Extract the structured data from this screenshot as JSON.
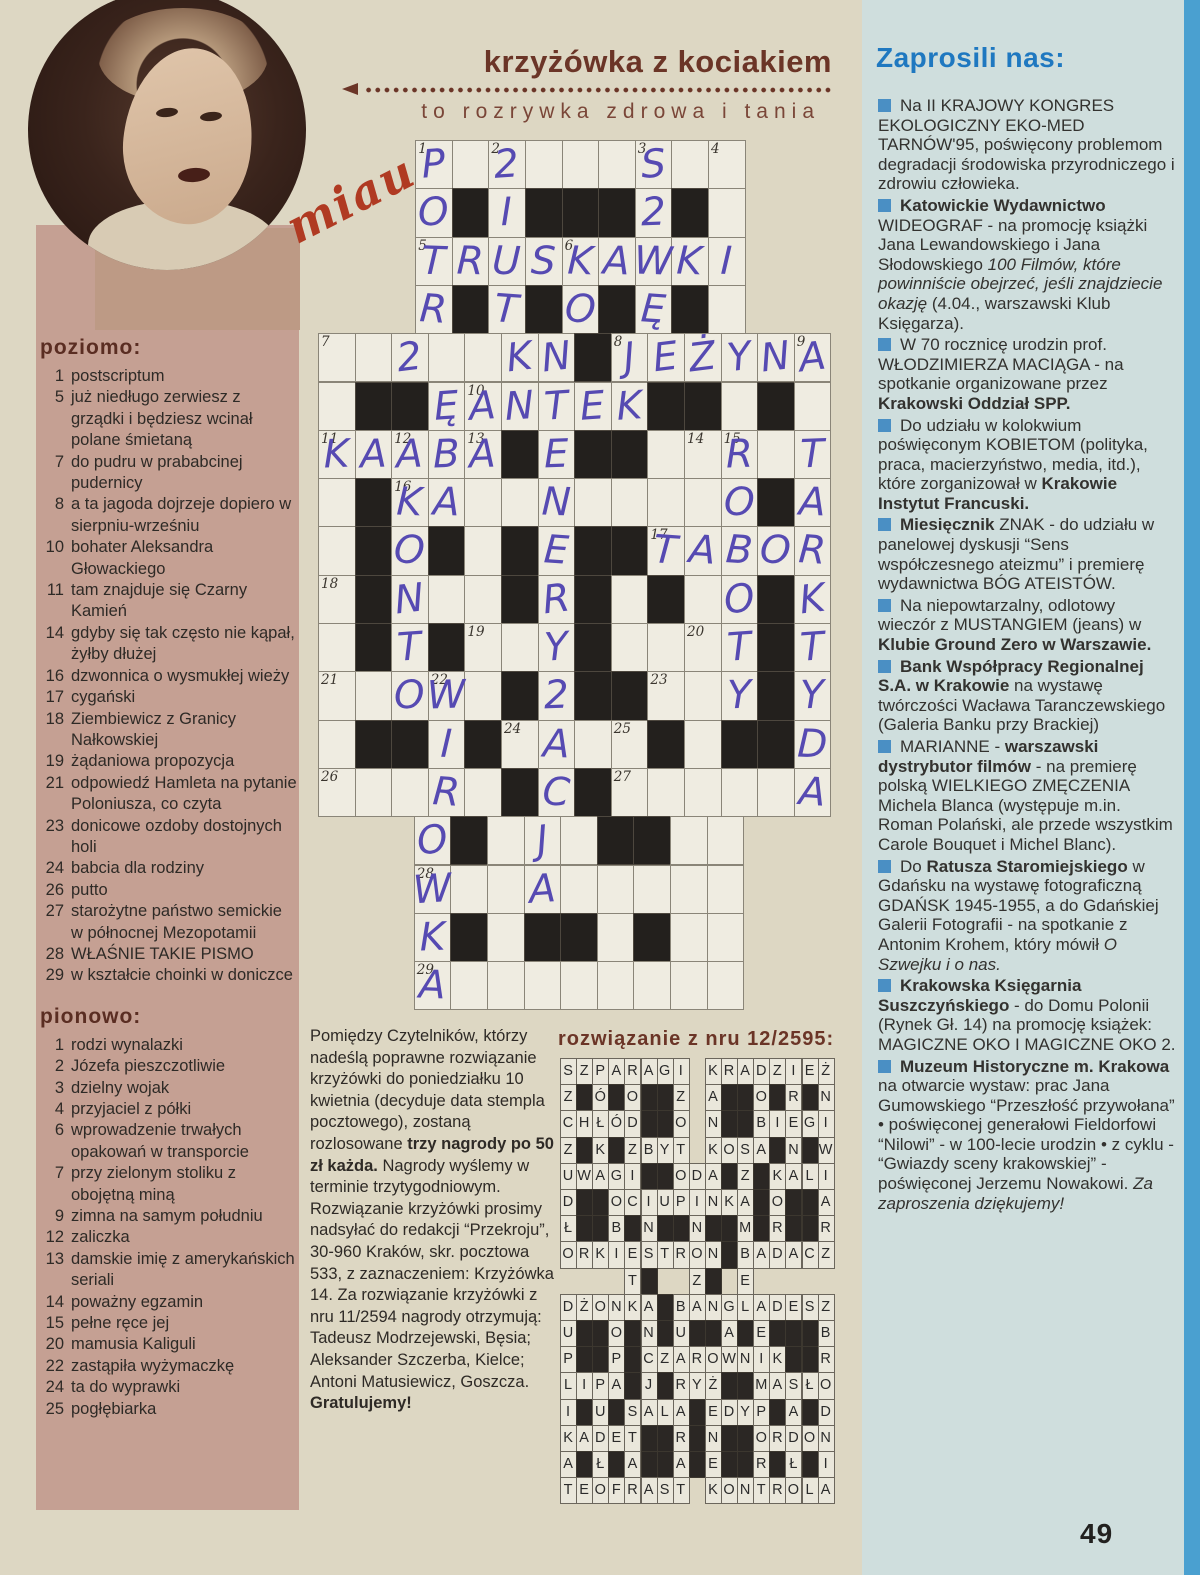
{
  "page": {
    "number": "49"
  },
  "colors": {
    "title_brown": "#6b3527",
    "heading_blue": "#1f78c0",
    "bullet_blue": "#4a8fc4",
    "handwriting_ink": "#564ab2",
    "pink_panel": "#c5a093",
    "right_panel": "#cfdedd",
    "edge_strip": "#4aa0d0"
  },
  "icons": {
    "arrow": "left-arrow-dotted-line",
    "bullet": "blue-square"
  },
  "masthead": {
    "title": "krzyżówka z kociakiem",
    "subtitle": "to rozrywka zdrowa i tania",
    "miau": "miau"
  },
  "clues": {
    "across_label": "poziomo:",
    "across": [
      {
        "num": "1",
        "text": "postscriptum"
      },
      {
        "num": "5",
        "text": "już niedługo zerwiesz z grządki i będziesz wcinał polane śmietaną"
      },
      {
        "num": "7",
        "text": "do pudru w prababcinej pudernicy"
      },
      {
        "num": "8",
        "text": "a ta jagoda dojrzeje dopiero w sierpniu-wrześniu"
      },
      {
        "num": "10",
        "text": "bohater Aleksandra Głowackiego"
      },
      {
        "num": "11",
        "text": "tam znajduje się Czarny Kamień"
      },
      {
        "num": "14",
        "text": "gdyby się tak często nie kąpał, żyłby dłużej"
      },
      {
        "num": "16",
        "text": "dzwonnica o wysmukłej wieży"
      },
      {
        "num": "17",
        "text": "cygański"
      },
      {
        "num": "18",
        "text": "Ziembiewicz z Granicy Nałkowskiej"
      },
      {
        "num": "19",
        "text": "żądaniowa propozycja"
      },
      {
        "num": "21",
        "text": "odpowiedź Hamleta na pytanie Poloniusza, co czyta"
      },
      {
        "num": "23",
        "text": "donicowe ozdoby dostojnych holi"
      },
      {
        "num": "24",
        "text": "babcia dla rodziny"
      },
      {
        "num": "26",
        "text": "putto"
      },
      {
        "num": "27",
        "text": "starożytne państwo semickie w północnej Mezopotamii"
      },
      {
        "num": "28",
        "text": "WŁAŚNIE TAKIE PISMO"
      },
      {
        "num": "29",
        "text": "w kształcie choinki w doniczce"
      }
    ],
    "down_label": "pionowo:",
    "down": [
      {
        "num": "1",
        "text": "rodzi wynalazki"
      },
      {
        "num": "2",
        "text": "Józefa pieszczotliwie"
      },
      {
        "num": "3",
        "text": "dzielny wojak"
      },
      {
        "num": "4",
        "text": "przyjaciel z półki"
      },
      {
        "num": "6",
        "text": "wprowadzenie trwałych opakowań w transporcie"
      },
      {
        "num": "7",
        "text": "przy zielonym stoliku z obojętną miną"
      },
      {
        "num": "9",
        "text": "zimna na samym południu"
      },
      {
        "num": "12",
        "text": "zaliczka"
      },
      {
        "num": "13",
        "text": "damskie imię z amerykańskich seriali"
      },
      {
        "num": "14",
        "text": "poważny egzamin"
      },
      {
        "num": "15",
        "text": "pełne ręce jej"
      },
      {
        "num": "20",
        "text": "mamusia Kaliguli"
      },
      {
        "num": "22",
        "text": "zastąpiła wyżymaczkę"
      },
      {
        "num": "24",
        "text": "ta do wyprawki"
      },
      {
        "num": "25",
        "text": "pogłębiarka"
      }
    ]
  },
  "crossword": {
    "cols": 14,
    "rows": 18,
    "cells": [
      "..---------...",
      "..-#-###-#-...",
      "..---------...",
      "..-#-#-#-#-...",
      "-------#------",
      "-##------##-#-",
      "-----#-##-----",
      "-#----------#-",
      "-#-#-#-##-----",
      "-#---#-#-#--#-",
      "-#-#---#----#-",
      "-----#-##---#-",
      "-##-#----#-##-",
      "-----#-#------",
      "...-#---##--..",
      "...---------..",
      "...-#-##-#--..",
      "...---------.."
    ],
    "numbers": [
      {
        "r": 1,
        "c": 3,
        "n": "1"
      },
      {
        "r": 1,
        "c": 5,
        "n": "2"
      },
      {
        "r": 1,
        "c": 9,
        "n": "3"
      },
      {
        "r": 1,
        "c": 11,
        "n": "4"
      },
      {
        "r": 3,
        "c": 3,
        "n": "5"
      },
      {
        "r": 3,
        "c": 7,
        "n": "6"
      },
      {
        "r": 5,
        "c": 1,
        "n": "7"
      },
      {
        "r": 5,
        "c": 9,
        "n": "8"
      },
      {
        "r": 5,
        "c": 14,
        "n": "9"
      },
      {
        "r": 6,
        "c": 5,
        "n": "10"
      },
      {
        "r": 7,
        "c": 1,
        "n": "11"
      },
      {
        "r": 7,
        "c": 3,
        "n": "12"
      },
      {
        "r": 7,
        "c": 5,
        "n": "13"
      },
      {
        "r": 7,
        "c": 11,
        "n": "14"
      },
      {
        "r": 7,
        "c": 12,
        "n": "15"
      },
      {
        "r": 8,
        "c": 3,
        "n": "16"
      },
      {
        "r": 9,
        "c": 10,
        "n": "17"
      },
      {
        "r": 10,
        "c": 1,
        "n": "18"
      },
      {
        "r": 11,
        "c": 5,
        "n": "19"
      },
      {
        "r": 11,
        "c": 11,
        "n": "20"
      },
      {
        "r": 12,
        "c": 1,
        "n": "21"
      },
      {
        "r": 12,
        "c": 4,
        "n": "22"
      },
      {
        "r": 12,
        "c": 10,
        "n": "23"
      },
      {
        "r": 13,
        "c": 6,
        "n": "24"
      },
      {
        "r": 13,
        "c": 9,
        "n": "25"
      },
      {
        "r": 14,
        "c": 1,
        "n": "26"
      },
      {
        "r": 14,
        "c": 9,
        "n": "27"
      },
      {
        "r": 16,
        "c": 4,
        "n": "28"
      },
      {
        "r": 18,
        "c": 4,
        "n": "29"
      }
    ],
    "letters": [
      {
        "r": 1,
        "c": 3,
        "ch": "P"
      },
      {
        "r": 1,
        "c": 5,
        "ch": "2"
      },
      {
        "r": 1,
        "c": 9,
        "ch": "S"
      },
      {
        "r": 2,
        "c": 3,
        "ch": "O"
      },
      {
        "r": 2,
        "c": 5,
        "ch": "I"
      },
      {
        "r": 2,
        "c": 9,
        "ch": "2"
      },
      {
        "r": 3,
        "c": 3,
        "ch": "T"
      },
      {
        "r": 3,
        "c": 4,
        "ch": "R"
      },
      {
        "r": 3,
        "c": 5,
        "ch": "U"
      },
      {
        "r": 3,
        "c": 6,
        "ch": "S"
      },
      {
        "r": 3,
        "c": 7,
        "ch": "K"
      },
      {
        "r": 3,
        "c": 8,
        "ch": "A"
      },
      {
        "r": 3,
        "c": 9,
        "ch": "W"
      },
      {
        "r": 3,
        "c": 10,
        "ch": "K"
      },
      {
        "r": 3,
        "c": 11,
        "ch": "I"
      },
      {
        "r": 4,
        "c": 3,
        "ch": "R"
      },
      {
        "r": 4,
        "c": 5,
        "ch": "T"
      },
      {
        "r": 4,
        "c": 7,
        "ch": "O"
      },
      {
        "r": 4,
        "c": 9,
        "ch": "Ę"
      },
      {
        "r": 5,
        "c": 3,
        "ch": "2"
      },
      {
        "r": 5,
        "c": 6,
        "ch": "K"
      },
      {
        "r": 5,
        "c": 7,
        "ch": "N"
      },
      {
        "r": 5,
        "c": 9,
        "ch": "J"
      },
      {
        "r": 5,
        "c": 10,
        "ch": "E"
      },
      {
        "r": 5,
        "c": 11,
        "ch": "Ż"
      },
      {
        "r": 5,
        "c": 12,
        "ch": "Y"
      },
      {
        "r": 5,
        "c": 13,
        "ch": "N"
      },
      {
        "r": 5,
        "c": 14,
        "ch": "A"
      },
      {
        "r": 6,
        "c": 4,
        "ch": "Ę"
      },
      {
        "r": 6,
        "c": 5,
        "ch": "A"
      },
      {
        "r": 6,
        "c": 6,
        "ch": "N"
      },
      {
        "r": 6,
        "c": 7,
        "ch": "T"
      },
      {
        "r": 6,
        "c": 8,
        "ch": "E"
      },
      {
        "r": 6,
        "c": 9,
        "ch": "K"
      },
      {
        "r": 7,
        "c": 1,
        "ch": "K"
      },
      {
        "r": 7,
        "c": 2,
        "ch": "A"
      },
      {
        "r": 7,
        "c": 3,
        "ch": "A"
      },
      {
        "r": 7,
        "c": 4,
        "ch": "B"
      },
      {
        "r": 7,
        "c": 5,
        "ch": "A"
      },
      {
        "r": 7,
        "c": 7,
        "ch": "E"
      },
      {
        "r": 7,
        "c": 12,
        "ch": "R"
      },
      {
        "r": 7,
        "c": 14,
        "ch": "T"
      },
      {
        "r": 8,
        "c": 3,
        "ch": "K"
      },
      {
        "r": 8,
        "c": 4,
        "ch": "A"
      },
      {
        "r": 8,
        "c": 7,
        "ch": "N"
      },
      {
        "r": 8,
        "c": 12,
        "ch": "O"
      },
      {
        "r": 8,
        "c": 14,
        "ch": "A"
      },
      {
        "r": 9,
        "c": 3,
        "ch": "O"
      },
      {
        "r": 9,
        "c": 7,
        "ch": "E"
      },
      {
        "r": 9,
        "c": 10,
        "ch": "T"
      },
      {
        "r": 9,
        "c": 11,
        "ch": "A"
      },
      {
        "r": 9,
        "c": 12,
        "ch": "B"
      },
      {
        "r": 9,
        "c": 13,
        "ch": "O"
      },
      {
        "r": 9,
        "c": 14,
        "ch": "R"
      },
      {
        "r": 10,
        "c": 3,
        "ch": "N"
      },
      {
        "r": 10,
        "c": 7,
        "ch": "R"
      },
      {
        "r": 10,
        "c": 12,
        "ch": "O"
      },
      {
        "r": 10,
        "c": 14,
        "ch": "K"
      },
      {
        "r": 11,
        "c": 3,
        "ch": "T"
      },
      {
        "r": 11,
        "c": 7,
        "ch": "Y"
      },
      {
        "r": 11,
        "c": 12,
        "ch": "T"
      },
      {
        "r": 11,
        "c": 14,
        "ch": "T"
      },
      {
        "r": 12,
        "c": 3,
        "ch": "O"
      },
      {
        "r": 12,
        "c": 4,
        "ch": "W"
      },
      {
        "r": 12,
        "c": 7,
        "ch": "2"
      },
      {
        "r": 12,
        "c": 12,
        "ch": "Y"
      },
      {
        "r": 12,
        "c": 14,
        "ch": "Y"
      },
      {
        "r": 13,
        "c": 4,
        "ch": "I"
      },
      {
        "r": 13,
        "c": 7,
        "ch": "A"
      },
      {
        "r": 13,
        "c": 14,
        "ch": "D"
      },
      {
        "r": 14,
        "c": 4,
        "ch": "R"
      },
      {
        "r": 14,
        "c": 7,
        "ch": "C"
      },
      {
        "r": 14,
        "c": 14,
        "ch": "A"
      },
      {
        "r": 15,
        "c": 4,
        "ch": "O"
      },
      {
        "r": 15,
        "c": 7,
        "ch": "J"
      },
      {
        "r": 16,
        "c": 4,
        "ch": "W"
      },
      {
        "r": 16,
        "c": 7,
        "ch": "A"
      },
      {
        "r": 17,
        "c": 4,
        "ch": "K"
      },
      {
        "r": 18,
        "c": 4,
        "ch": "A"
      }
    ]
  },
  "submission": {
    "segments": [
      {
        "t": "Pomiędzy Czytelników, którzy nadeślą poprawne rozwiązanie krzyżówki do poniedziałku 10 kwietnia (decyduje data stempla pocztowego), zostaną rozlosowane "
      },
      {
        "t": "trzy nagrody po 50 zł każda.",
        "b": true
      },
      {
        "t": " Nagrody wyślemy w terminie trzytygodniowym. Rozwiązanie krzyżówki prosimy nadsyłać do redakcji “Przekroju”, 30-960 Kraków, skr. pocztowa 533, z zaznaczeniem: Krzyżówka 14. Za rozwiązanie krzyżówki z nru 11/2594 nagrody otrzymują: Tadeusz Modrzejewski, Bęsia; Aleksander Szczerba, Kielce; Antoni Matusiewicz, Goszcza. "
      },
      {
        "t": "Gratulujemy!",
        "b": true
      }
    ]
  },
  "solution": {
    "heading": "rozwiązanie z nru 12/2595:",
    "cols": 17,
    "rows": 17,
    "grid": [
      "SZPARAGI.KRADZIEŻ",
      "Z#Ó#O##Z.A##O#R#N",
      "CHŁÓD##O.N##BIEGI",
      "Z#K#ZBYT.KOSA#N#W",
      "UWAGI##ODA#Z#KALI",
      "D##OCIUPINKA#O##A",
      "Ł##B#N##N##M#R##R",
      "ORKIESTRON#BADACZ",
      "....T#..Z#.E.....",
      "DŻONKA#BANGLADESZ",
      "U##O#N#U##A#E###B",
      "P##P#CZAROWNIK##R",
      "LIPA#J#RYŻ##MASŁO",
      "I#U#SALA#EDYP#A#D",
      "KADET##R#N##ORDON",
      "A#Ł#A##A#E##R#Ł#I",
      "TEOFRAST.KONTROLA"
    ]
  },
  "invites": {
    "heading": "Zaprosili nas:",
    "items": [
      {
        "segments": [
          {
            "t": "Na II KRAJOWY KONGRES EKOLOGICZNY EKO-MED TARNÓW'95, poświęcony problemom degradacji środowiska przyrodniczego i zdrowiu człowieka."
          }
        ]
      },
      {
        "segments": [
          {
            "t": "Katowickie Wydawnictwo",
            "b": true
          },
          {
            "t": " WIDEOGRAF - na promocję książki Jana Lewandowskiego i Jana Słodowskiego "
          },
          {
            "t": "100 Filmów, które powinniście obejrzeć, jeśli znajdziecie okazję",
            "i": true
          },
          {
            "t": " (4.04., warszawski Klub Księgarza)."
          }
        ]
      },
      {
        "segments": [
          {
            "t": "W 70 rocznicę urodzin prof. WŁODZIMIERZA MACIĄGA - na spotkanie organizowane przez "
          },
          {
            "t": "Krakowski Oddział SPP.",
            "b": true
          }
        ]
      },
      {
        "segments": [
          {
            "t": "Do udziału w kolokwium poświęconym KOBIETOM (polityka, praca, macierzyństwo, media, itd.), które zorganizował w "
          },
          {
            "t": "Krakowie Instytut Francuski.",
            "b": true
          }
        ]
      },
      {
        "segments": [
          {
            "t": "Miesięcznik",
            "b": true
          },
          {
            "t": " ZNAK - do udziału w panelowej dyskusji “Sens współczesnego ateizmu” i premierę wydawnictwa BÓG ATEISTÓW."
          }
        ]
      },
      {
        "segments": [
          {
            "t": "Na niepowtarzalny, odlotowy wieczór z MUSTANGIEM (jeans) w "
          },
          {
            "t": "Klubie Ground Zero w Warszawie.",
            "b": true
          }
        ]
      },
      {
        "segments": [
          {
            "t": "Bank Współpracy Regionalnej S.A. w Krakowie",
            "b": true
          },
          {
            "t": " na wystawę twórczości Wacława Taranczewskiego (Galeria Banku przy Brackiej)"
          }
        ]
      },
      {
        "segments": [
          {
            "t": "MARIANNE - "
          },
          {
            "t": "warszawski dystrybutor filmów",
            "b": true
          },
          {
            "t": " - na premierę polską WIELKIEGO ZMĘCZENIA Michela Blanca (występuje m.in. Roman Polański, ale przede wszystkim Carole Bouquet i Michel Blanc)."
          }
        ]
      },
      {
        "segments": [
          {
            "t": "Do "
          },
          {
            "t": "Ratusza Staromiejskiego",
            "b": true
          },
          {
            "t": " w Gdańsku na wystawę fotograficzną GDAŃSK 1945-1955, a do Gdańskiej Galerii Fotografii - na spotkanie z Antonim Krohem, który mówił "
          },
          {
            "t": "O Szwejku i o nas.",
            "i": true
          }
        ]
      },
      {
        "segments": [
          {
            "t": "Krakowska Księgarnia Suszczyńskiego",
            "b": true
          },
          {
            "t": " - do Domu Polonii (Rynek Gł. 14) na promocję książek: MAGICZNE OKO I MAGICZNE OKO 2."
          }
        ]
      },
      {
        "segments": [
          {
            "t": "Muzeum Historyczne m. Krakowa",
            "b": true
          },
          {
            "t": " na otwarcie wystaw: prac Jana Gumowskiego “Przeszłość przywołana” • poświęconej generałowi Fieldorfowi “Nilowi” - w 100-lecie urodzin • z cyklu - “Gwiazdy sceny krakowskiej” - poświęconej Jerzemu Nowakowi. "
          },
          {
            "t": "Za zaproszenia dziękujemy!",
            "i": true
          }
        ]
      }
    ]
  }
}
